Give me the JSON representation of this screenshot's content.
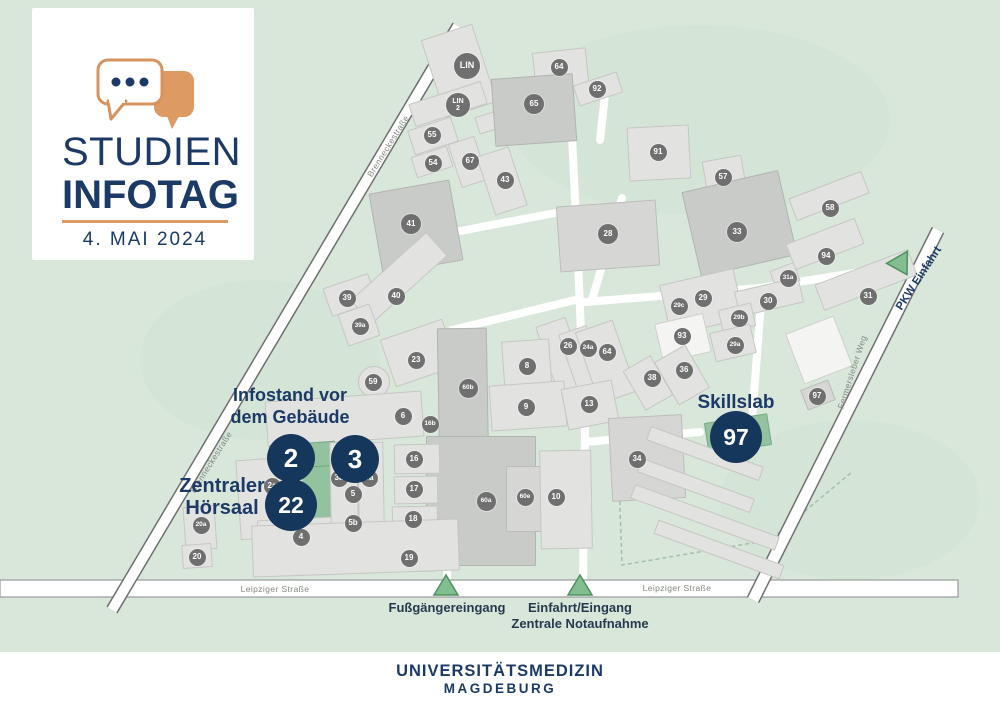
{
  "colors": {
    "navy": "#1c3a66",
    "orange": "#dd9a62",
    "map_bg": "#d9e7db",
    "building_gray": "#e2e2e1",
    "building_dark": "#c9cbc9",
    "badge_gray": "#6f6f6f",
    "highlight_green": "#93c29e",
    "entrance_triangle": "#82bf90",
    "street_label_gray": "#82887f"
  },
  "logo": {
    "title_line1": "STUDIEN",
    "title_line2": "INFOTAG",
    "date": "4. MAI 2024",
    "icon": "speech-bubbles"
  },
  "footer": {
    "line1": "UNIVERSITÄTSMEDIZIN",
    "line2": "MAGDEBURG"
  },
  "annotations": {
    "infostand_line1": "Infostand vor",
    "infostand_line2": "dem Gebäude",
    "hoersaal_line1": "Zentraler",
    "hoersaal_line2": "Hörsaal",
    "skillslab": "Skillslab",
    "pkw_einfahrt": "PKW Einfahrt",
    "fussgaenger": "Fußgängereingang",
    "einfahrt_line1": "Einfahrt/Eingang",
    "einfahrt_line2": "Zentrale Notaufnahme"
  },
  "streets": [
    {
      "name": "Brenneckestraße",
      "x": 388,
      "y": 146,
      "rot": -58
    },
    {
      "name": "Brenneckestraße",
      "x": 211,
      "y": 462,
      "rot": -58
    },
    {
      "name": "Leipziger Straße",
      "x": 275,
      "y": 589,
      "rot": 0
    },
    {
      "name": "Leipziger Straße",
      "x": 677,
      "y": 588,
      "rot": 0
    },
    {
      "name": "Fermersleber Weg",
      "x": 852,
      "y": 372,
      "rot": -72
    }
  ],
  "markers": [
    {
      "label": "2",
      "x": 291,
      "y": 458,
      "r": 24
    },
    {
      "label": "3",
      "x": 355,
      "y": 459,
      "r": 24
    },
    {
      "label": "22",
      "x": 291,
      "y": 505,
      "r": 26
    },
    {
      "label": "97",
      "x": 736,
      "y": 437,
      "r": 26
    }
  ],
  "badges": [
    {
      "label": "LIN",
      "x": 467,
      "y": 66,
      "d": 26,
      "f": 9
    },
    {
      "label": "LIN\n2",
      "x": 458,
      "y": 105,
      "d": 24,
      "f": 7
    },
    {
      "label": "64",
      "x": 559,
      "y": 67
    },
    {
      "label": "92",
      "x": 597,
      "y": 89
    },
    {
      "label": "65",
      "x": 534,
      "y": 104,
      "d": 20
    },
    {
      "label": "55",
      "x": 432,
      "y": 135
    },
    {
      "label": "54",
      "x": 433,
      "y": 163
    },
    {
      "label": "67",
      "x": 470,
      "y": 161
    },
    {
      "label": "43",
      "x": 505,
      "y": 180
    },
    {
      "label": "41",
      "x": 411,
      "y": 224,
      "d": 20
    },
    {
      "label": "91",
      "x": 658,
      "y": 152
    },
    {
      "label": "57",
      "x": 723,
      "y": 177
    },
    {
      "label": "28",
      "x": 608,
      "y": 234,
      "d": 20
    },
    {
      "label": "33",
      "x": 737,
      "y": 232,
      "d": 20
    },
    {
      "label": "58",
      "x": 830,
      "y": 208
    },
    {
      "label": "94",
      "x": 826,
      "y": 256
    },
    {
      "label": "31a",
      "x": 788,
      "y": 278
    },
    {
      "label": "31",
      "x": 868,
      "y": 296
    },
    {
      "label": "29c",
      "x": 679,
      "y": 306
    },
    {
      "label": "29",
      "x": 703,
      "y": 298
    },
    {
      "label": "30",
      "x": 768,
      "y": 301
    },
    {
      "label": "29b",
      "x": 739,
      "y": 318
    },
    {
      "label": "29a",
      "x": 735,
      "y": 345
    },
    {
      "label": "93",
      "x": 682,
      "y": 336
    },
    {
      "label": "26",
      "x": 568,
      "y": 346
    },
    {
      "label": "24a",
      "x": 588,
      "y": 348
    },
    {
      "label": "64",
      "x": 607,
      "y": 352
    },
    {
      "label": "8",
      "x": 527,
      "y": 366
    },
    {
      "label": "9",
      "x": 526,
      "y": 407
    },
    {
      "label": "13",
      "x": 589,
      "y": 404
    },
    {
      "label": "38",
      "x": 652,
      "y": 378
    },
    {
      "label": "36",
      "x": 684,
      "y": 370
    },
    {
      "label": "39",
      "x": 347,
      "y": 298
    },
    {
      "label": "40",
      "x": 396,
      "y": 296
    },
    {
      "label": "39a",
      "x": 360,
      "y": 326
    },
    {
      "label": "23",
      "x": 416,
      "y": 360
    },
    {
      "label": "59",
      "x": 373,
      "y": 382
    },
    {
      "label": "6",
      "x": 403,
      "y": 416
    },
    {
      "label": "16b",
      "x": 430,
      "y": 424
    },
    {
      "label": "60b",
      "x": 468,
      "y": 388,
      "d": 19
    },
    {
      "label": "60a",
      "x": 486,
      "y": 501,
      "d": 19
    },
    {
      "label": "60e",
      "x": 525,
      "y": 497
    },
    {
      "label": "10",
      "x": 556,
      "y": 497
    },
    {
      "label": "16",
      "x": 414,
      "y": 459
    },
    {
      "label": "17",
      "x": 414,
      "y": 489
    },
    {
      "label": "18",
      "x": 413,
      "y": 519
    },
    {
      "label": "19",
      "x": 409,
      "y": 558
    },
    {
      "label": "2a",
      "x": 272,
      "y": 486
    },
    {
      "label": "3a",
      "x": 339,
      "y": 478
    },
    {
      "label": "5a",
      "x": 369,
      "y": 478
    },
    {
      "label": "5",
      "x": 353,
      "y": 494
    },
    {
      "label": "5b",
      "x": 353,
      "y": 523
    },
    {
      "label": "4",
      "x": 301,
      "y": 537
    },
    {
      "label": "20a",
      "x": 201,
      "y": 525
    },
    {
      "label": "20",
      "x": 197,
      "y": 557
    },
    {
      "label": "34",
      "x": 637,
      "y": 459
    },
    {
      "label": "97",
      "x": 817,
      "y": 396
    }
  ],
  "buildings": [
    {
      "x": 432,
      "y": 30,
      "w": 52,
      "h": 80,
      "rot": -18,
      "shade": "light"
    },
    {
      "x": 410,
      "y": 92,
      "w": 74,
      "h": 22,
      "rot": -18,
      "shade": "light"
    },
    {
      "x": 476,
      "y": 110,
      "w": 44,
      "h": 16,
      "rot": -18,
      "shade": "light"
    },
    {
      "x": 534,
      "y": 50,
      "w": 52,
      "h": 42,
      "rot": -6,
      "shade": "light"
    },
    {
      "x": 575,
      "y": 78,
      "w": 44,
      "h": 20,
      "rot": -18,
      "shade": "light"
    },
    {
      "x": 493,
      "y": 76,
      "w": 80,
      "h": 66,
      "rot": -4,
      "shade": "dark"
    },
    {
      "x": 410,
      "y": 123,
      "w": 44,
      "h": 24,
      "rot": -18,
      "shade": "light"
    },
    {
      "x": 413,
      "y": 151,
      "w": 36,
      "h": 20,
      "rot": -18,
      "shade": "light"
    },
    {
      "x": 454,
      "y": 139,
      "w": 26,
      "h": 44,
      "rot": -18,
      "shade": "light"
    },
    {
      "x": 485,
      "y": 150,
      "w": 32,
      "h": 60,
      "rot": -18,
      "shade": "light"
    },
    {
      "x": 375,
      "y": 186,
      "w": 80,
      "h": 80,
      "rot": -10,
      "shade": "dark"
    },
    {
      "x": 628,
      "y": 126,
      "w": 60,
      "h": 52,
      "rot": -3,
      "shade": "light"
    },
    {
      "x": 704,
      "y": 158,
      "w": 38,
      "h": 28,
      "rot": -10,
      "shade": "light"
    },
    {
      "x": 690,
      "y": 180,
      "w": 97,
      "h": 85,
      "rot": -13,
      "shade": "dark"
    },
    {
      "x": 558,
      "y": 203,
      "w": 98,
      "h": 64,
      "rot": -4,
      "shade": "mid"
    },
    {
      "x": 790,
      "y": 184,
      "w": 76,
      "h": 22,
      "rot": -21,
      "shade": "light"
    },
    {
      "x": 788,
      "y": 230,
      "w": 72,
      "h": 26,
      "rot": -21,
      "shade": "light"
    },
    {
      "x": 772,
      "y": 266,
      "w": 24,
      "h": 18,
      "rot": -21,
      "shade": "light"
    },
    {
      "x": 816,
      "y": 266,
      "w": 98,
      "h": 26,
      "rot": -21,
      "shade": "light"
    },
    {
      "x": 664,
      "y": 276,
      "w": 74,
      "h": 50,
      "rot": -13,
      "shade": "light"
    },
    {
      "x": 736,
      "y": 284,
      "w": 64,
      "h": 24,
      "rot": -13,
      "shade": "light"
    },
    {
      "x": 720,
      "y": 306,
      "w": 32,
      "h": 22,
      "rot": -13,
      "shade": "light"
    },
    {
      "x": 712,
      "y": 328,
      "w": 40,
      "h": 28,
      "rot": -13,
      "shade": "light"
    },
    {
      "x": 658,
      "y": 318,
      "w": 48,
      "h": 38,
      "rot": -13,
      "shade": "white"
    },
    {
      "x": 546,
      "y": 320,
      "w": 30,
      "h": 70,
      "rot": -19,
      "shade": "light"
    },
    {
      "x": 568,
      "y": 328,
      "w": 28,
      "h": 64,
      "rot": -19,
      "shade": "light"
    },
    {
      "x": 586,
      "y": 324,
      "w": 38,
      "h": 74,
      "rot": -19,
      "shade": "light"
    },
    {
      "x": 503,
      "y": 340,
      "w": 46,
      "h": 54,
      "rot": -4,
      "shade": "light"
    },
    {
      "x": 490,
      "y": 383,
      "w": 74,
      "h": 44,
      "rot": -4,
      "shade": "light"
    },
    {
      "x": 564,
      "y": 384,
      "w": 50,
      "h": 40,
      "rot": -11,
      "shade": "light"
    },
    {
      "x": 632,
      "y": 360,
      "w": 30,
      "h": 44,
      "rot": -30,
      "shade": "light"
    },
    {
      "x": 664,
      "y": 350,
      "w": 34,
      "h": 48,
      "rot": -30,
      "shade": "light"
    },
    {
      "x": 326,
      "y": 280,
      "w": 46,
      "h": 28,
      "rot": -19,
      "shade": "light"
    },
    {
      "x": 348,
      "y": 262,
      "w": 100,
      "h": 30,
      "rot": -42,
      "shade": "light"
    },
    {
      "x": 342,
      "y": 308,
      "w": 32,
      "h": 32,
      "rot": -19,
      "shade": "light"
    },
    {
      "x": 386,
      "y": 328,
      "w": 64,
      "h": 48,
      "rot": -19,
      "shade": "light"
    },
    {
      "x": 358,
      "y": 366,
      "w": 30,
      "h": 30,
      "rot": 0,
      "shade": "light",
      "round": true
    },
    {
      "x": 388,
      "y": 403,
      "w": 30,
      "h": 26,
      "rot": -6,
      "shade": "light"
    },
    {
      "x": 438,
      "y": 328,
      "w": 48,
      "h": 138,
      "rot": -1,
      "shade": "dark"
    },
    {
      "x": 426,
      "y": 436,
      "w": 108,
      "h": 128,
      "rot": 0,
      "shade": "dark"
    },
    {
      "x": 506,
      "y": 466,
      "w": 42,
      "h": 64,
      "rot": 0,
      "shade": "mid"
    },
    {
      "x": 540,
      "y": 450,
      "w": 50,
      "h": 97,
      "rot": -1,
      "shade": "light"
    },
    {
      "x": 394,
      "y": 444,
      "w": 44,
      "h": 28,
      "rot": -1,
      "shade": "light"
    },
    {
      "x": 394,
      "y": 476,
      "w": 42,
      "h": 26,
      "rot": -1,
      "shade": "light"
    },
    {
      "x": 392,
      "y": 506,
      "w": 44,
      "h": 26,
      "rot": -1,
      "shade": "light"
    },
    {
      "x": 386,
      "y": 546,
      "w": 46,
      "h": 24,
      "rot": -1,
      "shade": "light"
    },
    {
      "x": 266,
      "y": 396,
      "w": 155,
      "h": 44,
      "rot": -4,
      "shade": "light"
    },
    {
      "x": 270,
      "y": 443,
      "w": 64,
      "h": 24,
      "rot": -4,
      "shade": "green"
    },
    {
      "x": 296,
      "y": 466,
      "w": 42,
      "h": 54,
      "rot": -4,
      "shade": "green"
    },
    {
      "x": 238,
      "y": 458,
      "w": 64,
      "h": 78,
      "rot": -4,
      "shade": "light"
    },
    {
      "x": 258,
      "y": 518,
      "w": 92,
      "h": 40,
      "rot": -3,
      "shade": "light"
    },
    {
      "x": 330,
      "y": 442,
      "w": 26,
      "h": 84,
      "rot": -1,
      "shade": "light"
    },
    {
      "x": 358,
      "y": 442,
      "w": 24,
      "h": 84,
      "rot": -1,
      "shade": "light"
    },
    {
      "x": 184,
      "y": 506,
      "w": 30,
      "h": 42,
      "rot": -4,
      "shade": "light"
    },
    {
      "x": 182,
      "y": 544,
      "w": 28,
      "h": 22,
      "rot": -4,
      "shade": "light"
    },
    {
      "x": 252,
      "y": 522,
      "w": 205,
      "h": 50,
      "rot": -2,
      "shade": "light"
    },
    {
      "x": 610,
      "y": 416,
      "w": 72,
      "h": 82,
      "rot": -3,
      "shade": "mid"
    },
    {
      "x": 706,
      "y": 418,
      "w": 62,
      "h": 30,
      "rot": -9,
      "shade": "green"
    },
    {
      "x": 645,
      "y": 446,
      "w": 118,
      "h": 13,
      "rot": 20,
      "shade": "light"
    },
    {
      "x": 636,
      "y": 478,
      "w": 118,
      "h": 13,
      "rot": 20,
      "shade": "light"
    },
    {
      "x": 628,
      "y": 510,
      "w": 152,
      "h": 13,
      "rot": 20,
      "shade": "light"
    },
    {
      "x": 652,
      "y": 542,
      "w": 132,
      "h": 13,
      "rot": 20,
      "shade": "light"
    },
    {
      "x": 793,
      "y": 323,
      "w": 50,
      "h": 52,
      "rot": -21,
      "shade": "white"
    },
    {
      "x": 803,
      "y": 384,
      "w": 28,
      "h": 20,
      "rot": -21,
      "shade": "mid"
    }
  ]
}
